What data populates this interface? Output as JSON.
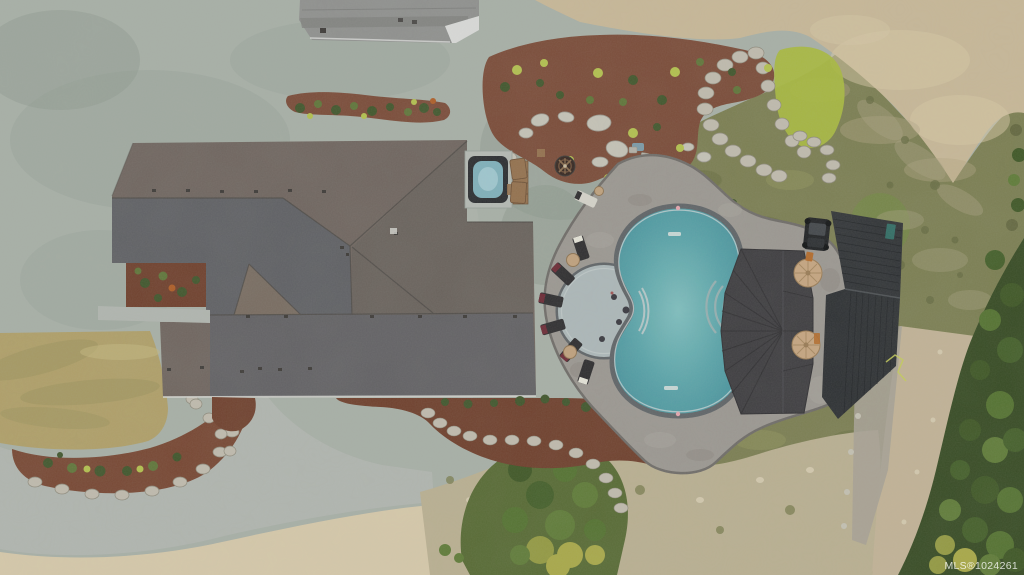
{
  "image": {
    "watermark": "MLS®1024261",
    "description": "Aerial drone photo of an estate home with a figure-eight swimming pool, circular tanning ledge, poolside pavilion, hot tub, fire pit and landscaped grounds"
  },
  "scene": {
    "features": [
      "gravel yard",
      "concrete driveway and walkway",
      "detached garage at top edge",
      "main house with multi-plane shingle roof",
      "interior courtyard planting bed",
      "square hot tub on pad with wood bench",
      "round gas fire pit with log set",
      "mulch garden beds with shrubs and boulders",
      "rock retaining walls",
      "paver pool deck",
      "figure-eight swimming pool with fan steps",
      "circular tanning ledge with in-water furniture",
      "seven lounge chairs with side tables",
      "dark hip-roof pavilion",
      "two cream patio umbrellas",
      "metal-roof outbuilding",
      "utility vehicle",
      "olive lawn and scrub field",
      "bare graded dirt",
      "gravel trail",
      "evergreen forest edge",
      "dry grass field",
      "sand soil areas"
    ],
    "counts": {
      "lounge_chairs": 7,
      "umbrellas": 2,
      "side_tables": 3
    }
  },
  "colors": {
    "gravel": "#a9b0a7",
    "gravel_dark": "#96a098",
    "gravel_light": "#b7bdb4",
    "gravel_green": "#8c988c",
    "sand": "#cbb997",
    "sand_light": "#dacaa6",
    "sand_dark": "#b5a482",
    "bottom_sand": "#dacbaa",
    "dirt": "#bcb091",
    "dirt_light": "#d6cbae",
    "path": "#c4b496",
    "rubble": "#a8a295",
    "rubble_stone": "#c7c2b4",
    "dry_grass": "#b1a066",
    "dry_grass_dark": "#998b55",
    "dry_grass_light": "#c9b97d",
    "olive": "#7b7d4e",
    "olive_dark": "#64693c",
    "olive_light": "#90925a",
    "scrub_tan": "#a89f7e",
    "scrub_dot": "#62663c",
    "lime": "#aaba3c",
    "bright_green": "#6f8a3c",
    "forest": "#33471e",
    "tree1": "#415c24",
    "tree2": "#52702c",
    "tree3": "#3b5420",
    "tree4": "#5d7a33",
    "tree_yellow": "#aaa944",
    "tree_lime": "#94993e",
    "tree_base": "#55682f",
    "mulch": "#7a4733",
    "mulch_dark": "#6e3b28",
    "mulch_arc": "#77432e",
    "roof_warm": "#6e635c",
    "roof_cool": "#5b5c62",
    "roof_cool2": "#5e5d61",
    "roof_diag": "#655d58",
    "roof_gable": "#786a5e",
    "ridge": "#494440",
    "eave": "#d9d9d3",
    "vent": "#3a3633",
    "outbuilding": "#90908e",
    "outbuilding_dark": "#7f7f7d",
    "outbuilding_trim": "#dddddb",
    "pavers": "#9c9791",
    "paver_light": "#b2aca2",
    "paver_dark": "#837d74",
    "paver_edge": "#6e6a66",
    "coping": "#5d6165",
    "waterline": "#cfd8d8",
    "pool_light": "#7fc0c0",
    "pool_mid": "#58a5aa",
    "pool_deep": "#44909c",
    "ledge": "#aeb9ba",
    "step": "#9db1b2",
    "step_light": "#c6cfcf",
    "pool_dot": "#35333a",
    "pool_dot_red": "#a15050",
    "skimmer": "#dfe5e2",
    "pool_marker": "#e8a7b0",
    "chair": "#2a282a",
    "pillow_white": "#e8e6da",
    "pillow_red": "#6b2430",
    "table": "#c2a27c",
    "table_edge": "#8f724f",
    "pavilion": "#3a383b",
    "pavilion_line": "#2c2a2d",
    "pavilion_fold": "#47454a",
    "umbrella": "#c9a67f",
    "umbrella_line": "#a8875e",
    "umbrella_edge": "#9a7a52",
    "metal": "#2c2e31",
    "metal_b": "#292b2e",
    "rib": "#1b1d20",
    "metal_ridge": "#4a4d51",
    "atv": "#1b1c1e",
    "atv_top": "#3f4246",
    "tire": "#0b0c0d",
    "teal_equip": "#2e6b62",
    "orange_equip": "#b66a28",
    "hose": "#c8cf56",
    "boulder": "#c8c4b8",
    "boulder_edge": "#98948a",
    "rock": "#c2bcae",
    "rock_edge": "#8e897a",
    "shrub": "#3d5326",
    "shrub_light": "#5d7334",
    "shrub_yellow": "#b5c24a",
    "shrub_orange": "#b05a20",
    "pad": "#b7bbb5",
    "tub_frame": "#26282b",
    "tub_water": "#7fb2bc",
    "tub_swirl": "#a9ced6",
    "bench": "#946e49",
    "bench_dark": "#6b4c31",
    "firepit": "#31201a",
    "firepit_ring": "#6b4a33",
    "firepit_spoke": "#8a6a4a",
    "log": "#c9b89a",
    "stone": "#b6b2a7",
    "stone_edge": "#908c80",
    "walkway": "#b3b7b0",
    "blue_item": "#7a9aa8",
    "white_item": "#d8d5cc",
    "haze": "#8a95a0",
    "watermark": "rgba(255,255,255,0.78)"
  }
}
